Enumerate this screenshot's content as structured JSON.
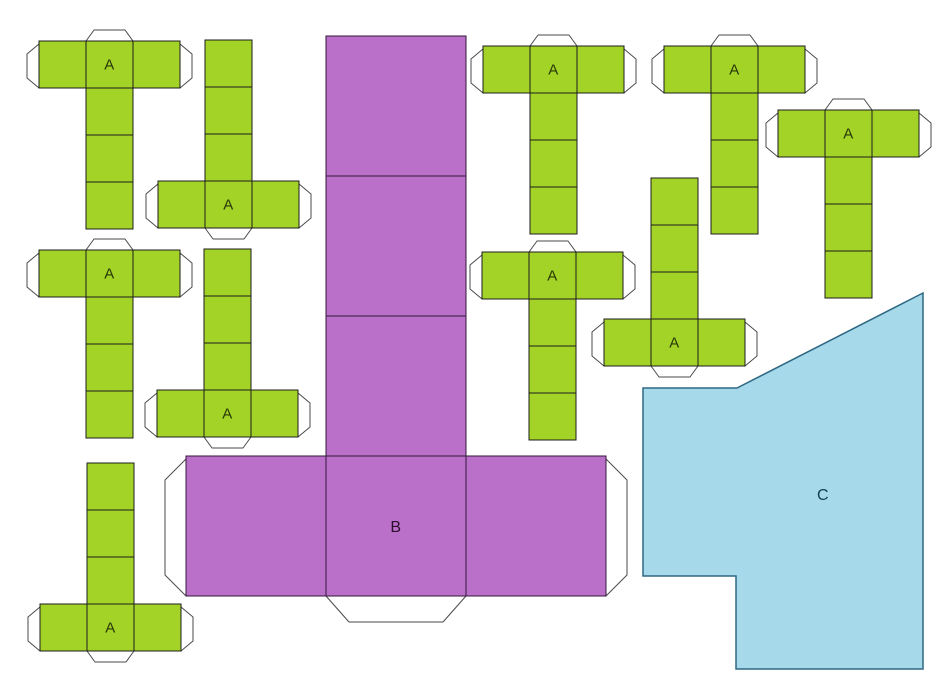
{
  "sheet": {
    "width": 946,
    "height": 683,
    "background": "#ffffff",
    "description": "Printable paper-craft cube net template sheet with green cube nets (A), one large purple cuboid net (B) and a light blue polygon piece (C)"
  },
  "styles": {
    "green_fill": "#a3d327",
    "green_stroke": "#1c1c1c",
    "purple_fill": "#ba70c8",
    "purple_stroke": "#33173a",
    "blue_fill": "#a6d9e9",
    "blue_stroke": "#2e6884",
    "tab_fill": "#ffffff",
    "tab_stroke": "#4a4a4a",
    "label_a_color": "#283708",
    "label_b_color": "#2b102e",
    "label_c_color": "#113f52"
  },
  "green_nets": {
    "label": "A",
    "square": 47,
    "tab_geometry": {
      "side": 12,
      "slant": 10,
      "mid": 11,
      "inset": 8
    },
    "items": [
      {
        "type": "T",
        "row_x": 39,
        "row_y": 41
      },
      {
        "type": "T",
        "row_x": 483,
        "row_y": 46
      },
      {
        "type": "T",
        "row_x": 664,
        "row_y": 46
      },
      {
        "type": "T",
        "row_x": 778,
        "row_y": 110
      },
      {
        "type": "T",
        "row_x": 39,
        "row_y": 250
      },
      {
        "type": "T",
        "row_x": 482,
        "row_y": 252
      },
      {
        "type": "invT",
        "col_x": 205,
        "col_y": 40
      },
      {
        "type": "invT",
        "col_x": 204,
        "col_y": 249
      },
      {
        "type": "invT",
        "col_x": 651,
        "col_y": 178
      },
      {
        "type": "invT",
        "col_x": 87,
        "col_y": 463
      }
    ]
  },
  "purple_net": {
    "label": "B",
    "type": "invT",
    "square": 140,
    "col_x": 326,
    "col_y": 36,
    "tab_geometry": {
      "side": 21,
      "slant": 21,
      "mid": 26,
      "inset": 23
    }
  },
  "c_shape": {
    "label": "C",
    "points": [
      [
        923,
        293
      ],
      [
        737,
        388
      ],
      [
        643,
        388
      ],
      [
        643,
        576
      ],
      [
        736,
        576
      ],
      [
        736,
        669
      ],
      [
        923,
        669
      ]
    ],
    "label_pos": [
      823,
      494
    ]
  }
}
